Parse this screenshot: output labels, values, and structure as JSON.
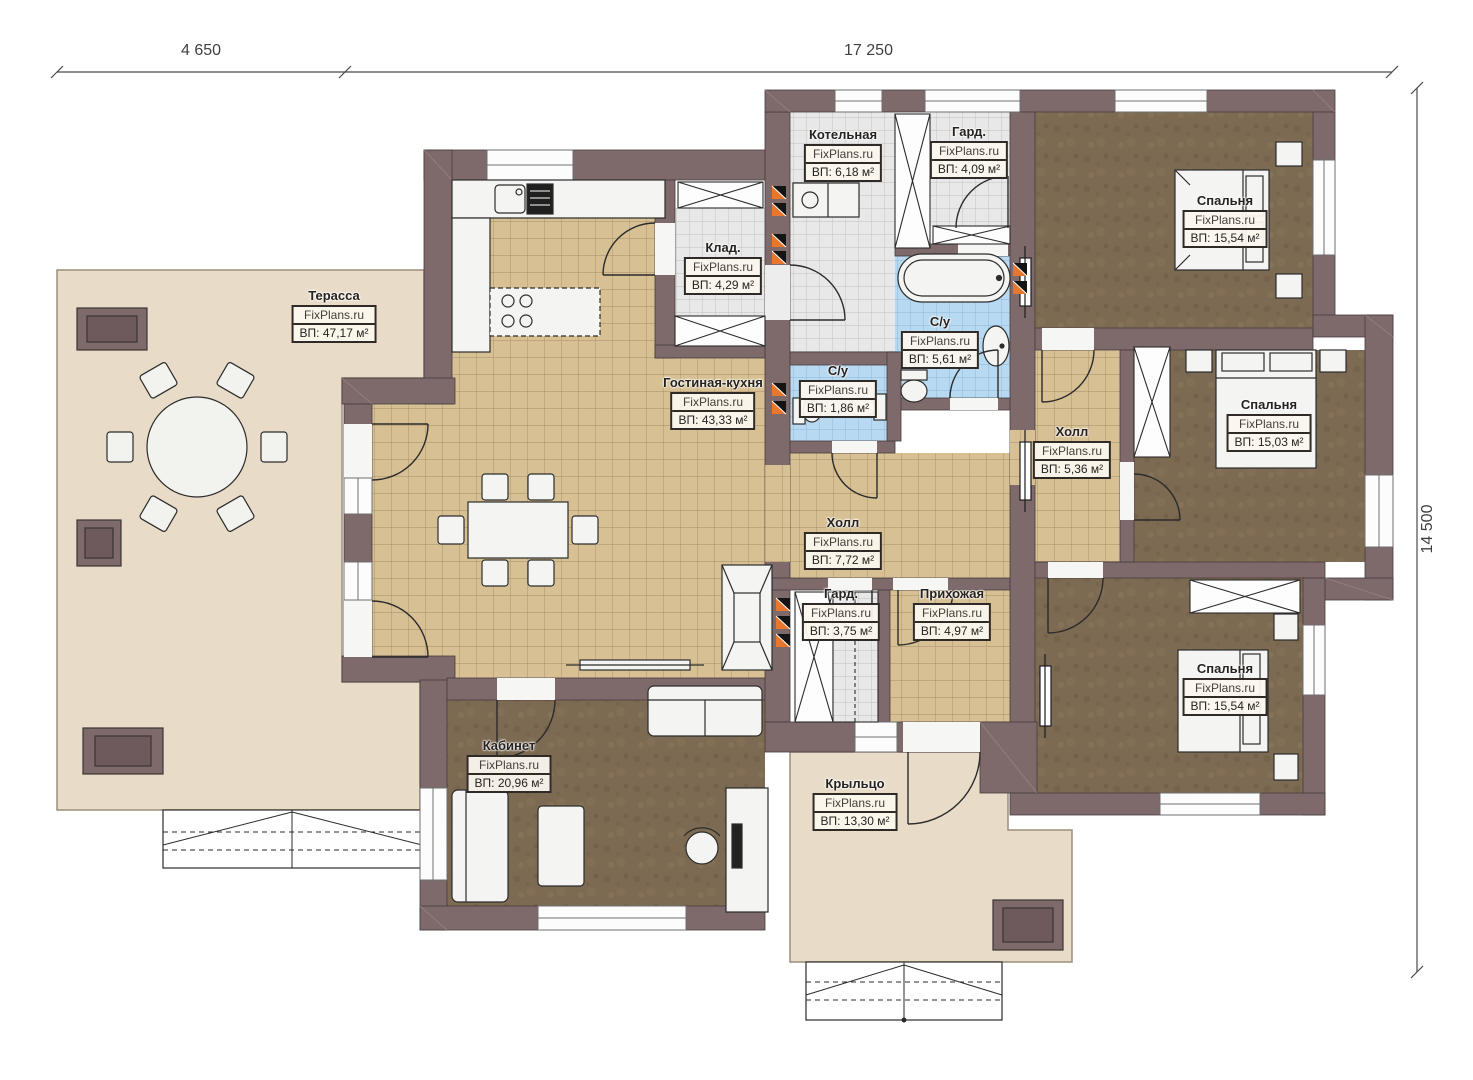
{
  "brand": "FixPlans.ru",
  "dimensions": {
    "width_left": "4 650",
    "width_main": "17 250",
    "height": "14 500"
  },
  "colors": {
    "wall": "#7e696b",
    "floor_tile_tan": "#d7c093",
    "floor_tile_gray": "#e8e8e8",
    "floor_tile_blue": "#b7d9f1",
    "floor_carpet_brown": "#7d6a52",
    "terrace": "#e8dcc8",
    "vent_orange": "#e8772e"
  },
  "rooms": {
    "terrace": {
      "name": "Терасса",
      "area": "ВП: 47,17 м²"
    },
    "boiler": {
      "name": "Котельная",
      "area": "ВП: 6,18 м²"
    },
    "wardrobe_top": {
      "name": "Гард.",
      "area": "ВП: 4,09 м²"
    },
    "pantry": {
      "name": "Клад.",
      "area": "ВП: 4,29 м²"
    },
    "bedroom_ne": {
      "name": "Спальня",
      "area": "ВП: 15,54 м²"
    },
    "bathroom_main": {
      "name": "С/у",
      "area": "ВП: 5,61 м²"
    },
    "bathroom_guest": {
      "name": "С/у",
      "area": "ВП: 1,86 м²"
    },
    "living_kitchen": {
      "name": "Гостиная-кухня",
      "area": "ВП: 43,33 м²"
    },
    "hall_east": {
      "name": "Холл",
      "area": "ВП: 5,36 м²"
    },
    "bedroom_e": {
      "name": "Спальня",
      "area": "ВП: 15,03 м²"
    },
    "hall_center": {
      "name": "Холл",
      "area": "ВП: 7,72 м²"
    },
    "wardrobe_lower": {
      "name": "Гард.",
      "area": "ВП: 3,75 м²"
    },
    "entry": {
      "name": "Прихожая",
      "area": "ВП: 4,97 м²"
    },
    "bedroom_se": {
      "name": "Спальня",
      "area": "ВП: 15,54 м²"
    },
    "office": {
      "name": "Кабинет",
      "area": "ВП: 20,96 м²"
    },
    "porch": {
      "name": "Крыльцо",
      "area": "ВП: 13,30 м²"
    }
  }
}
